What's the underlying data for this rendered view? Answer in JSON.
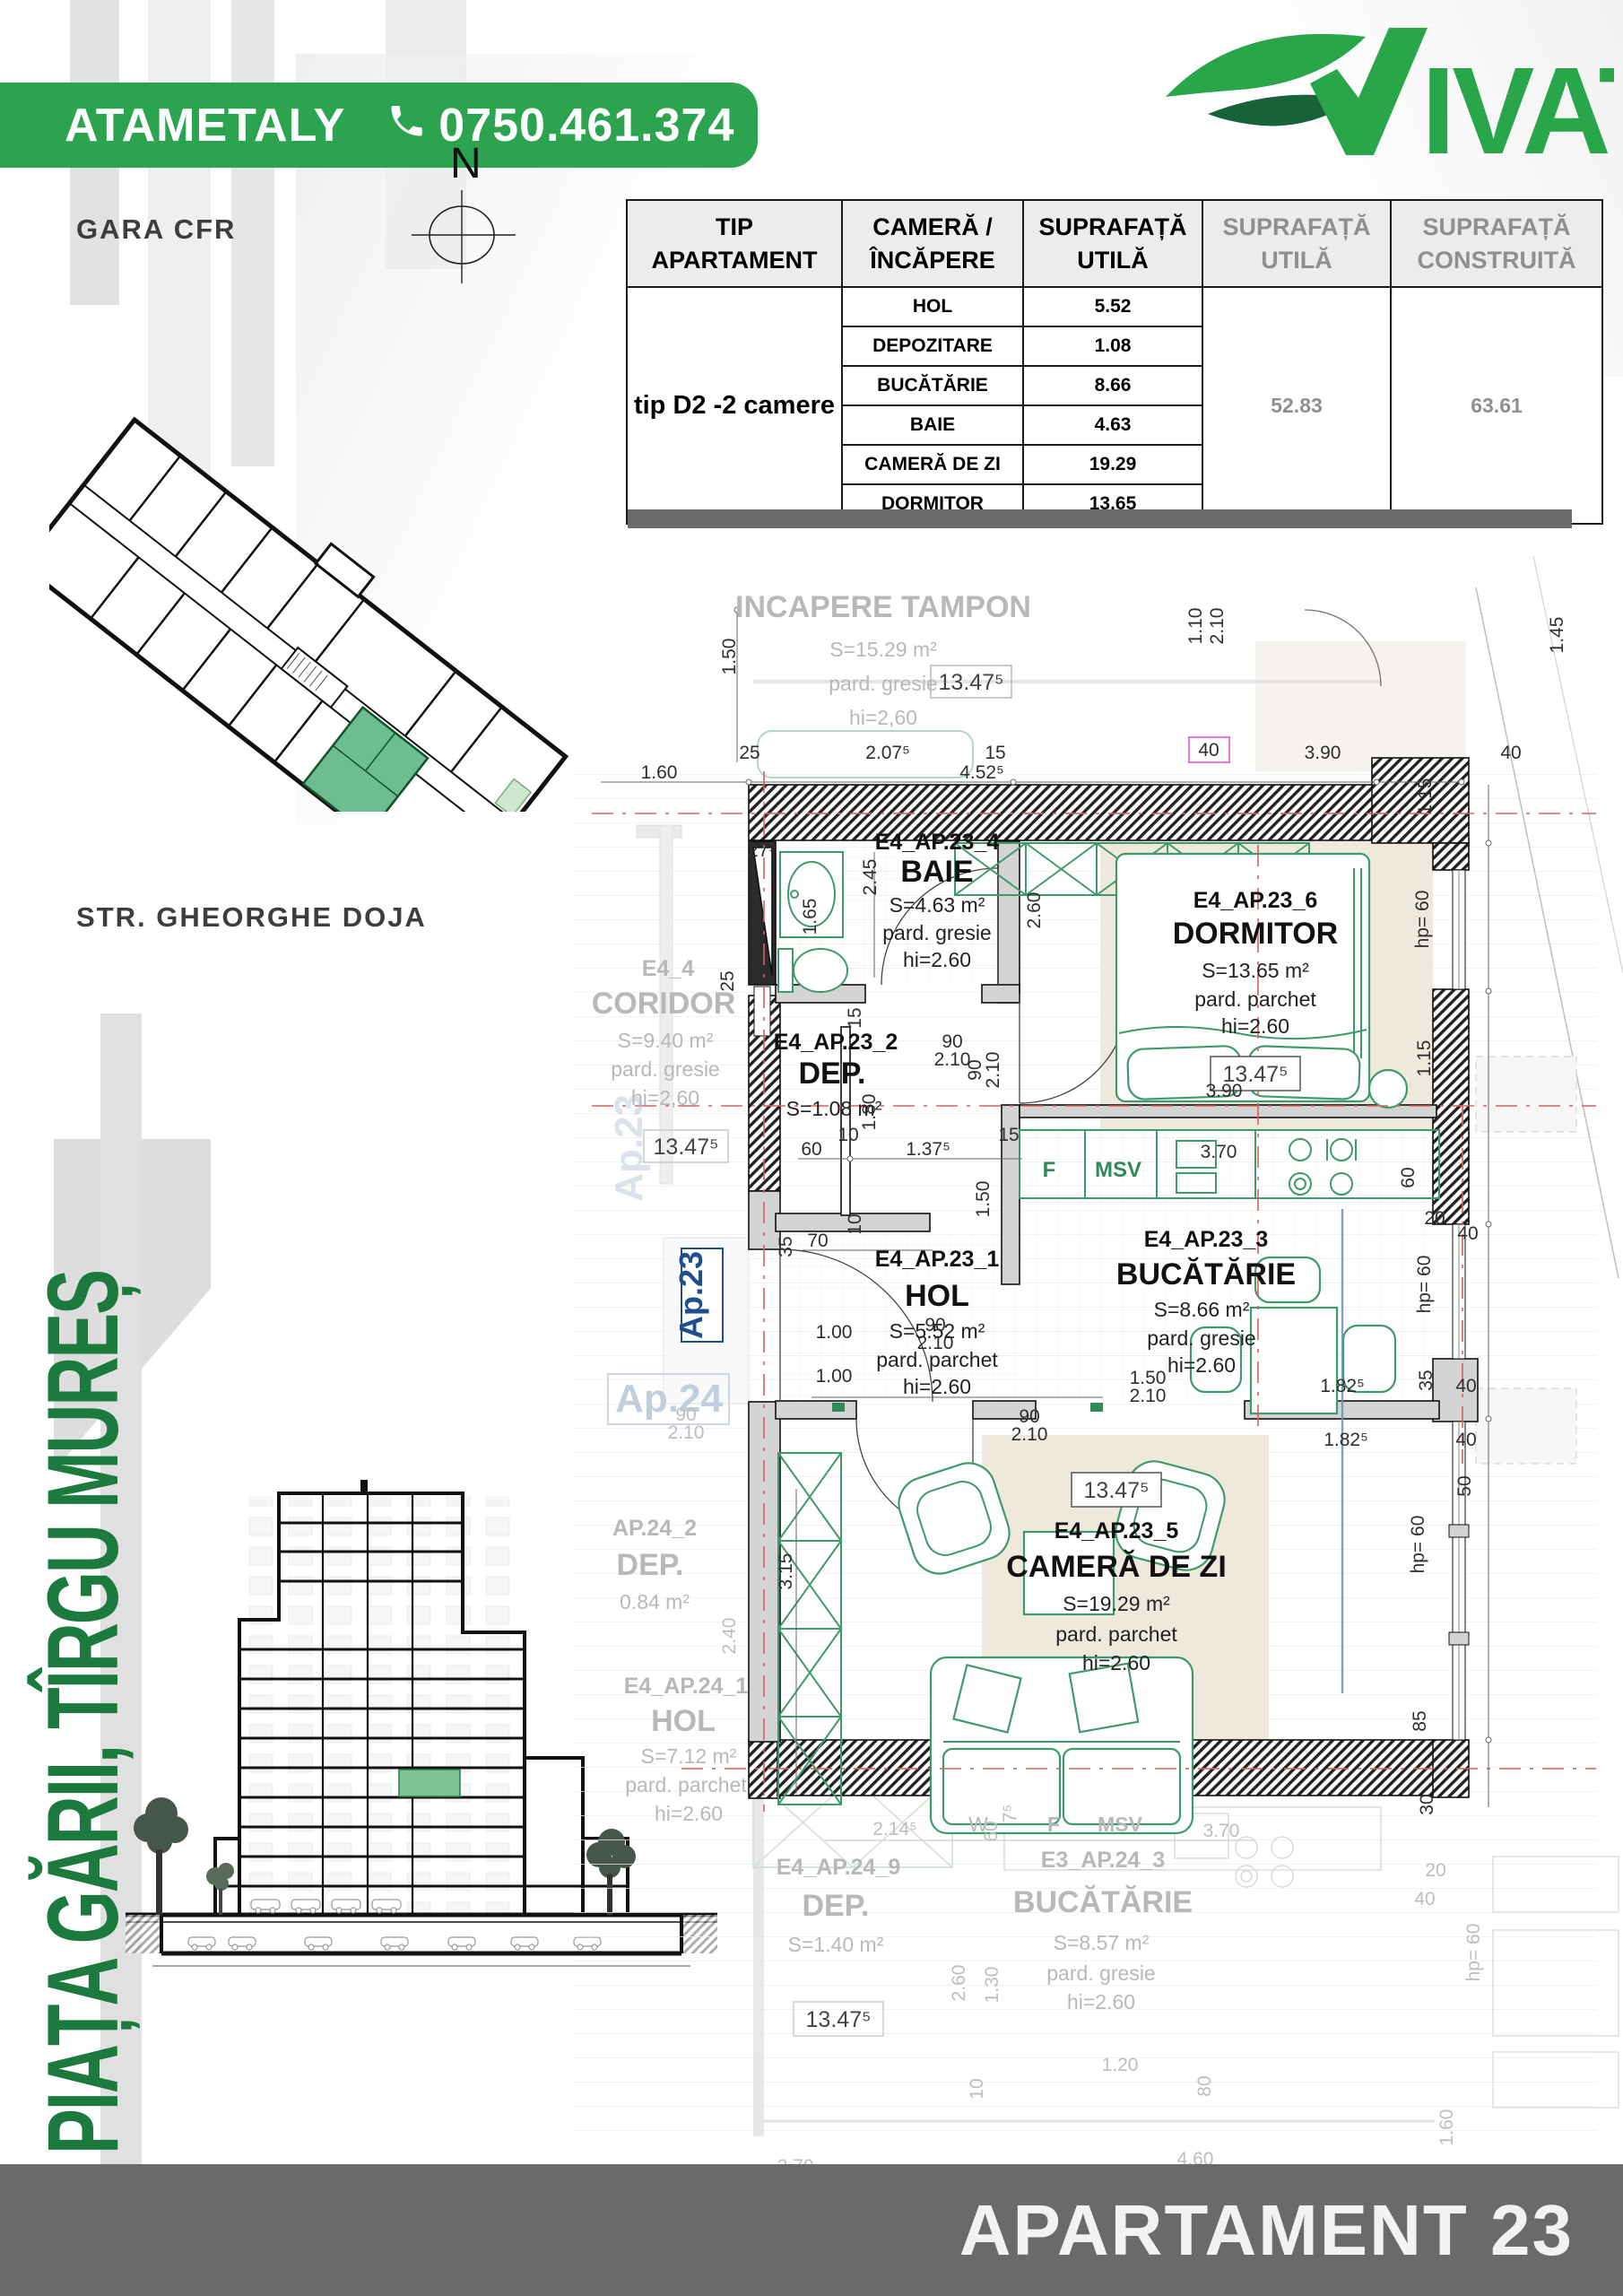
{
  "banner": {
    "agent": "ATAMETALY",
    "phone": "0750.461.374"
  },
  "brand": {
    "name": "VIVAT",
    "tail": "IVAT"
  },
  "compass": {
    "n": "N"
  },
  "map": {
    "gara": "GARA CFR",
    "street": "STR. GHEORGHE DOJA",
    "plaza": "PIAȚA GĂRII, TÎRGU MUREȘ"
  },
  "table": {
    "col_headers": [
      "TIP APARTAMENT",
      "CAMERĂ / ÎNCĂPERE",
      "SUPRAFAȚĂ UTILĂ",
      "SUPRAFAȚĂ UTILĂ",
      "SUPRAFAȚĂ CONSTRUITĂ"
    ],
    "apartment_type": "tip D2 -2 camere",
    "rows": [
      {
        "room": "HOL",
        "area": "5.52"
      },
      {
        "room": "DEPOZITARE",
        "area": "1.08"
      },
      {
        "room": "BUCĂTĂRIE",
        "area": "8.66"
      },
      {
        "room": "BAIE",
        "area": "4.63"
      },
      {
        "room": "CAMERĂ DE ZI",
        "area": "19.29"
      },
      {
        "room": "DORMITOR",
        "area": "13.65"
      }
    ],
    "total_useful": "52.83",
    "total_built": "63.61"
  },
  "footer": {
    "title": "APARTAMENT 23"
  },
  "plan": {
    "rooms": {
      "tampon": {
        "name": "INCAPERE TAMPON",
        "area": "S=15.29 m²",
        "floor": "pard. gresie",
        "height": "hi=2,60",
        "level": "13.47⁵"
      },
      "baie": {
        "id": "E4_AP.23_4",
        "name": "BAIE",
        "area": "S=4.63 m²",
        "floor": "pard. gresie",
        "height": "hi=2.60"
      },
      "dormitor": {
        "id": "E4_AP.23_6",
        "name": "DORMITOR",
        "area": "S=13.65 m²",
        "floor": "pard. parchet",
        "height": "hi=2.60",
        "level": "13.47⁵"
      },
      "dep": {
        "id": "E4_AP.23_2",
        "name": "DEP.",
        "area": "S=1.08 m²"
      },
      "hol": {
        "id": "E4_AP.23_1",
        "name": "HOL",
        "area": "S=5.52 m²",
        "floor": "pard. parchet",
        "height": "hi=2.60"
      },
      "bucatarie": {
        "id": "E4_AP.23_3",
        "name": "BUCĂTĂRIE",
        "area": "S=8.66 m²",
        "floor": "pard. gresie",
        "height": "hi=2.60"
      },
      "camera": {
        "id": "E4_AP.23_5",
        "name": "CAMERĂ DE ZI",
        "area": "S=19.29 m²",
        "floor": "pard. parchet",
        "height": "hi=2.60",
        "level": "13.47⁵"
      },
      "coridor": {
        "id": "E4_4",
        "name": "CORIDOR",
        "area": "S=9.40 m²",
        "floor": "pard. gresie",
        "height": "hi=2,60",
        "level": "13.47⁵"
      },
      "ap24_dep": {
        "id": "AP.24_2",
        "name": "DEP.",
        "area": "0.84 m²"
      },
      "ap24_hol": {
        "id": "E4_AP.24_1",
        "name": "HOL",
        "area": "S=7.12 m²",
        "floor": "pard. parchet",
        "height": "hi=2.60"
      },
      "ap24_dep9": {
        "id": "E4_AP.24_9",
        "name": "DEP.",
        "area": "S=1.40 m²",
        "level": "13.47⁵"
      },
      "ap24_buc": {
        "id": "E3_AP.24_3",
        "name": "BUCĂTĂRIE",
        "area": "S=8.57 m²",
        "floor": "pard. gresie",
        "height": "hi=2.60"
      }
    },
    "labels": {
      "ap23": "Ap.23",
      "ap24": "Ap.24"
    },
    "kitchen": {
      "f": "F",
      "msv": "MSV"
    },
    "faded_kitchen": {
      "f": "F",
      "msv": "MSV",
      "w": "W"
    },
    "dims": [
      "25",
      "2.07⁵",
      "15",
      "3.90",
      "40",
      "1.60",
      "4.52⁵",
      "1.50",
      "1.10",
      "2.10",
      "1.45",
      "40",
      "27⁵",
      "2.45",
      "1.65",
      "2.60",
      "hp= 60",
      "1.15",
      "1.15",
      "3.90",
      "15",
      "90",
      "2.10",
      "90",
      "2.10",
      "1.80",
      "10",
      "60",
      "1.37⁵",
      "15",
      "10",
      "35",
      "70",
      "1.50",
      "90",
      "2.10",
      "1.00",
      "1.00",
      "90",
      "2.10",
      "3.15",
      "2.40",
      "25",
      "3.70",
      "60",
      "20",
      "40",
      "hp= 60",
      "1.82⁵",
      "35",
      "40",
      "1.82⁵",
      "40",
      "1.50",
      "2.10",
      "50",
      "hp= 60",
      "85",
      "30",
      "2.14⁵",
      "2.60",
      "1.30",
      "1.20",
      "80",
      "10",
      "2.70",
      "60",
      "3.70",
      "90",
      "2.10",
      "hp= 60",
      "40",
      "20",
      "1.60",
      "4.60",
      "7⁵"
    ]
  }
}
